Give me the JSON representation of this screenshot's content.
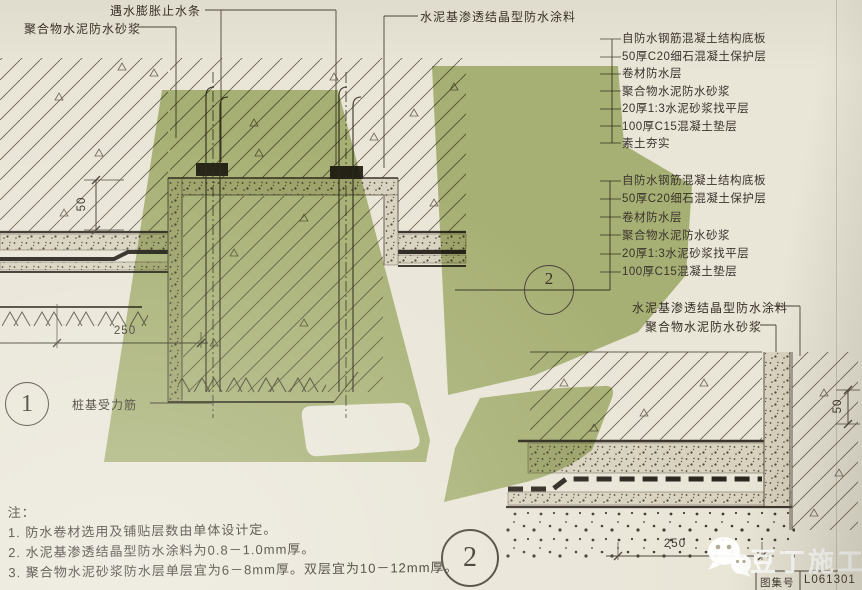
{
  "drawing": {
    "labels": {
      "polymer_mortar_top": "聚合物水泥防水砂浆",
      "waterstop_top": "遇水膨胀止水条",
      "crystalline_top": "水泥基渗透结晶型防水涂料",
      "crystalline_side": "水泥基渗透结晶型防水涂料",
      "polymer_mortar_side": "聚合物水泥防水砂浆",
      "pile_rebar": "桩基受力筋"
    },
    "layer_list_top": [
      "自防水钢筋混凝土结构底板",
      "50厚C20细石混凝土保护层",
      "卷材防水层",
      "聚合物水泥防水砂浆",
      "20厚1:3水泥砂浆找平层",
      "100厚C15混凝土垫层",
      "素土夯实"
    ],
    "layer_list_bottom": [
      "自防水钢筋混凝土结构底板",
      "50厚C20细石混凝土保护层",
      "卷材防水层",
      "聚合物水泥防水砂浆",
      "20厚1:3水泥砂浆找平层",
      "100厚C15混凝土垫层"
    ],
    "dimensions": {
      "left_height": "50",
      "left_width": "250",
      "right_height": "50",
      "right_width": "250"
    },
    "detail_markers": {
      "detail_1": "1",
      "detail_2": "2",
      "section_ref_number": "2"
    }
  },
  "notes": {
    "heading": "注：",
    "items": [
      "1.  防水卷材选用及铺贴层数由单体设计定。",
      "2.  水泥基渗透结晶型防水涂料为0.8－1.0mm厚。",
      "3.  聚合物水泥砂浆防水层单层宜为6－8mm厚。双层宜为10－12mm厚。"
    ]
  },
  "watermark": {
    "brand": "豆丁施工"
  },
  "title_block": {
    "label": "图集号",
    "value": "L061301"
  },
  "colors": {
    "paper": "#e9e5d7",
    "line": "#5d5446",
    "ink": "#352e24",
    "membrane": "#2a251d",
    "watermark_green": "#a3b467"
  }
}
